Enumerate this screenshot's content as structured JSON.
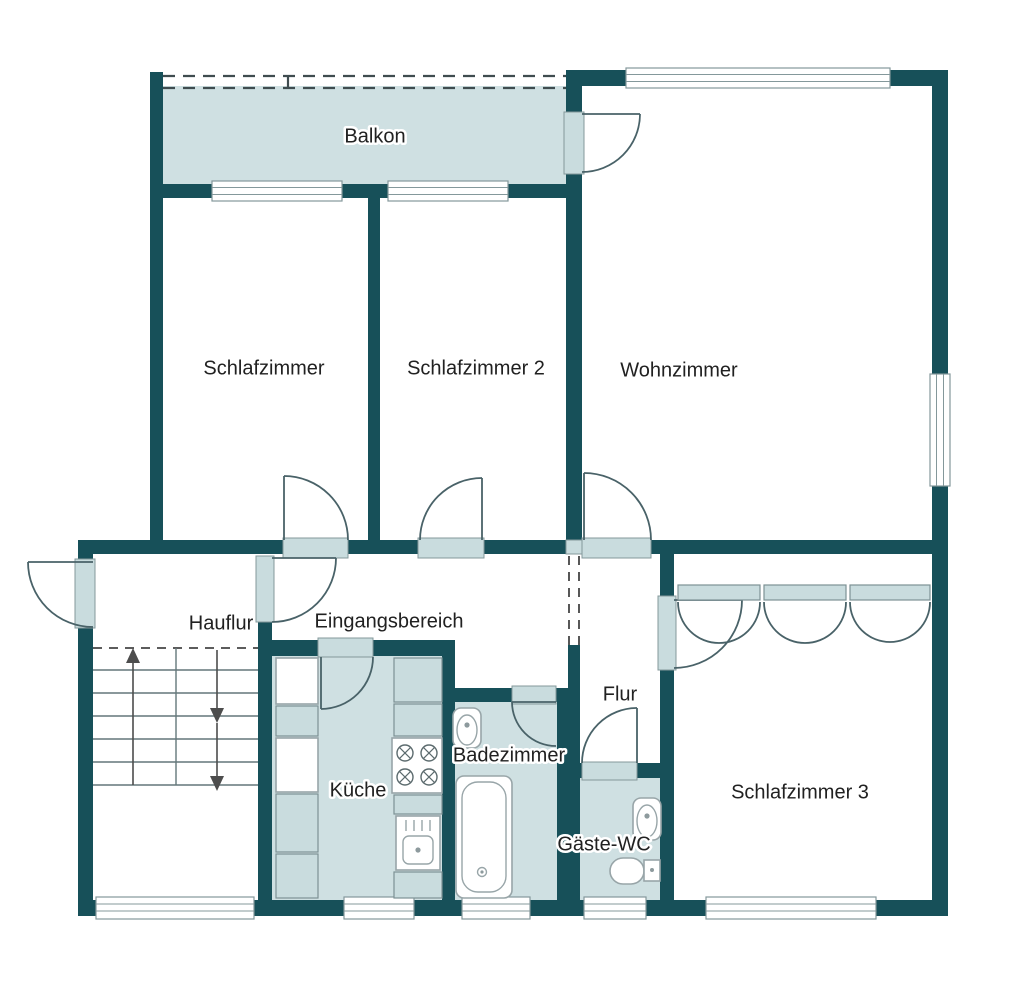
{
  "title": "Apartment floor plan",
  "colors": {
    "wall": "#175059",
    "shaded_room_fill": "#cfe0e2",
    "door_sill_fill": "#c9dcde",
    "room_fill": "#ffffff",
    "window_outline": "#84989b",
    "door_arc": "#496268",
    "label_text": "#212121"
  },
  "rooms": {
    "balkon": "Balkon",
    "schlafzimmer": "Schlafzimmer",
    "schlafzimmer2": "Schlafzimmer 2",
    "wohnzimmer": "Wohnzimmer",
    "hauflur": "Hauflur",
    "eingangsbereich": "Eingangsbereich",
    "flur": "Flur",
    "kueche": "Küche",
    "badezimmer": "Badezimmer",
    "gaeste_wc": "Gäste-WC",
    "schlafzimmer3": "Schlafzimmer 3"
  },
  "icons": {
    "stove": "4-burner-cooktop-icon",
    "kitchen_sink": "kitchen-sink-icon",
    "bathtub": "bathtub-icon",
    "toilet_bath": "toilet-icon",
    "toilet_wc": "toilet-icon",
    "wc_sink": "hand-basin-icon",
    "stairs": "staircase-with-up-down-arrows-icon",
    "wardrobe": "built-in-wardrobe-icon",
    "balcony_railing": "dashed-railing",
    "doors": "door-swing-arc-symbols",
    "windows": "window-sill-symbols"
  }
}
